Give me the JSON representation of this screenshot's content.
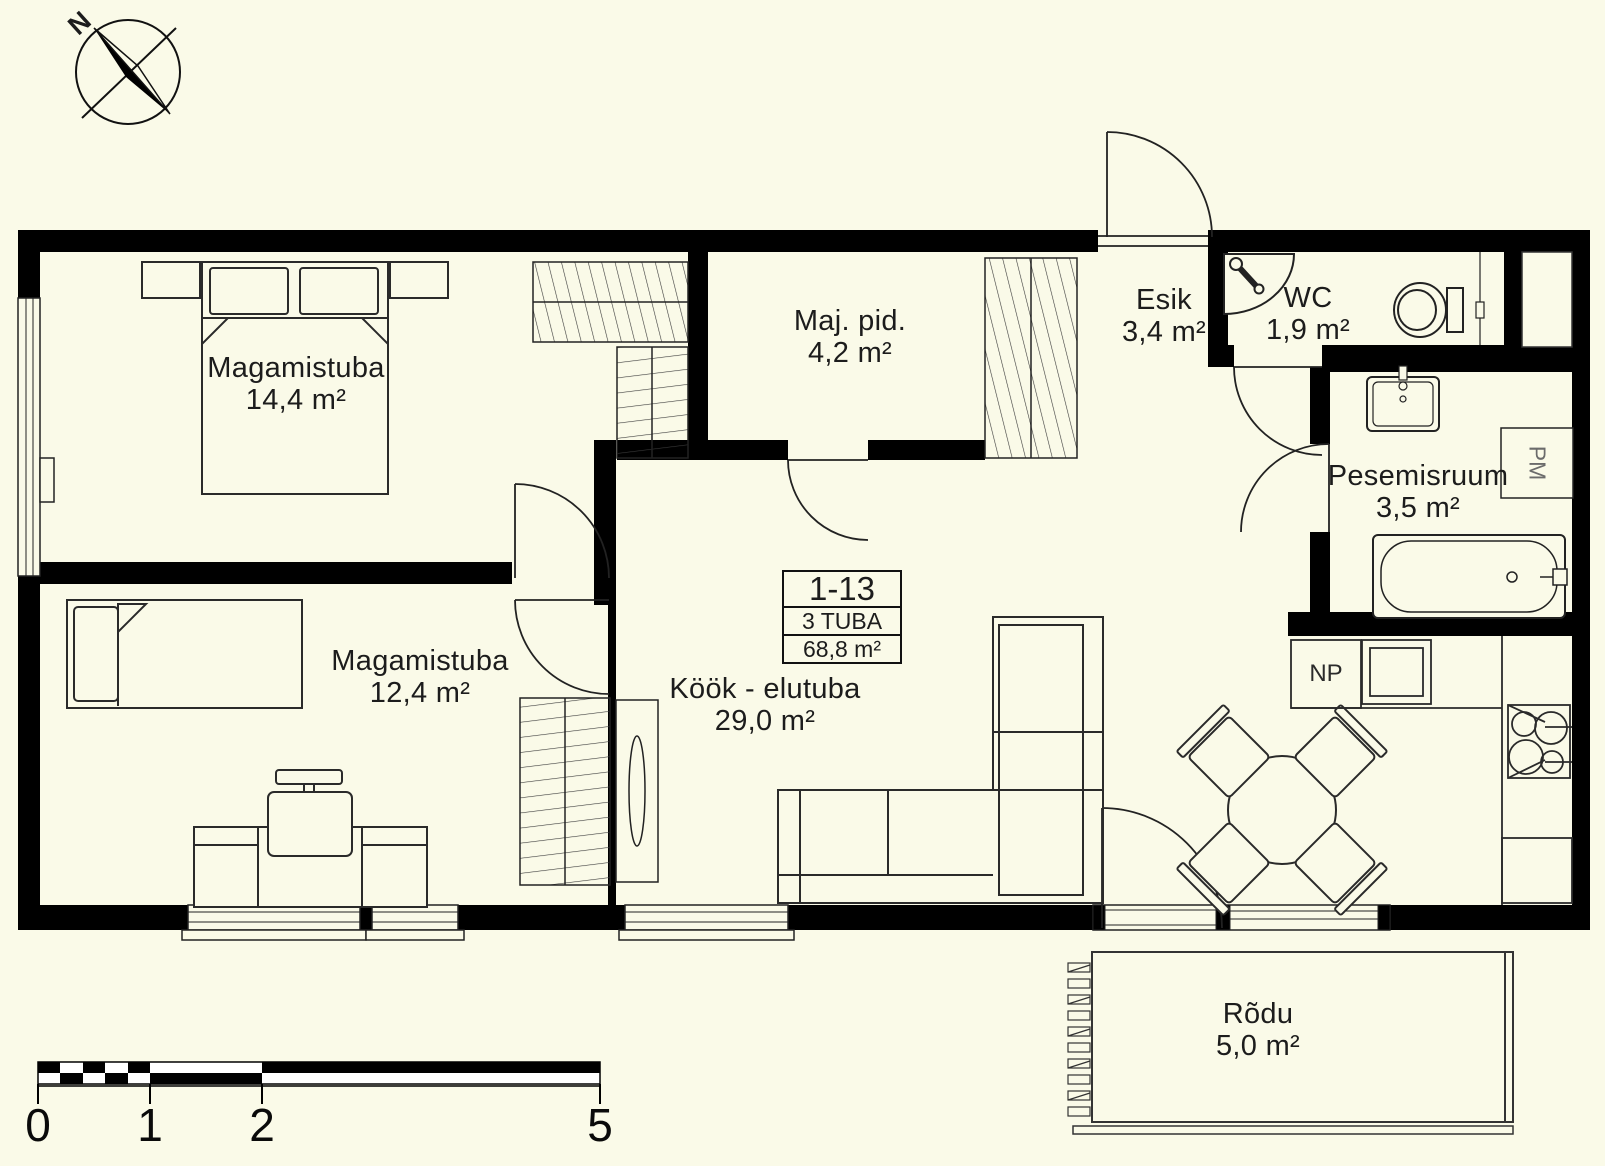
{
  "colors": {
    "background": "#fafae8",
    "walls": "#000000",
    "lines": "#222222"
  },
  "compass": {
    "north_label": "N"
  },
  "unit_info": {
    "number": "1-13",
    "rooms": "3 TUBA",
    "area": "68,8 m²"
  },
  "rooms": [
    {
      "id": "magamistuba-1",
      "name": "Magamistuba",
      "area": "14,4 m²"
    },
    {
      "id": "magamistuba-2",
      "name": "Magamistuba",
      "area": "12,4 m²"
    },
    {
      "id": "maj-pid",
      "name": "Maj. pid.",
      "area": "4,2 m²"
    },
    {
      "id": "esik",
      "name": "Esik",
      "area": "3,4 m²"
    },
    {
      "id": "wc",
      "name": "WC",
      "area": "1,9 m²"
    },
    {
      "id": "pesemisruum",
      "name": "Pesemisruum",
      "area": "3,5 m²"
    },
    {
      "id": "kook-elutuba",
      "name": "Köök - elutuba",
      "area": "29,0 m²"
    },
    {
      "id": "rodu",
      "name": "Rõdu",
      "area": "5,0 m²"
    }
  ],
  "appliances": {
    "washing_machine_label": "PM",
    "dishwasher_label": "NP",
    "fridge_label": "K"
  },
  "scale_bar": {
    "labels": [
      "0",
      "1",
      "2",
      "5"
    ]
  }
}
